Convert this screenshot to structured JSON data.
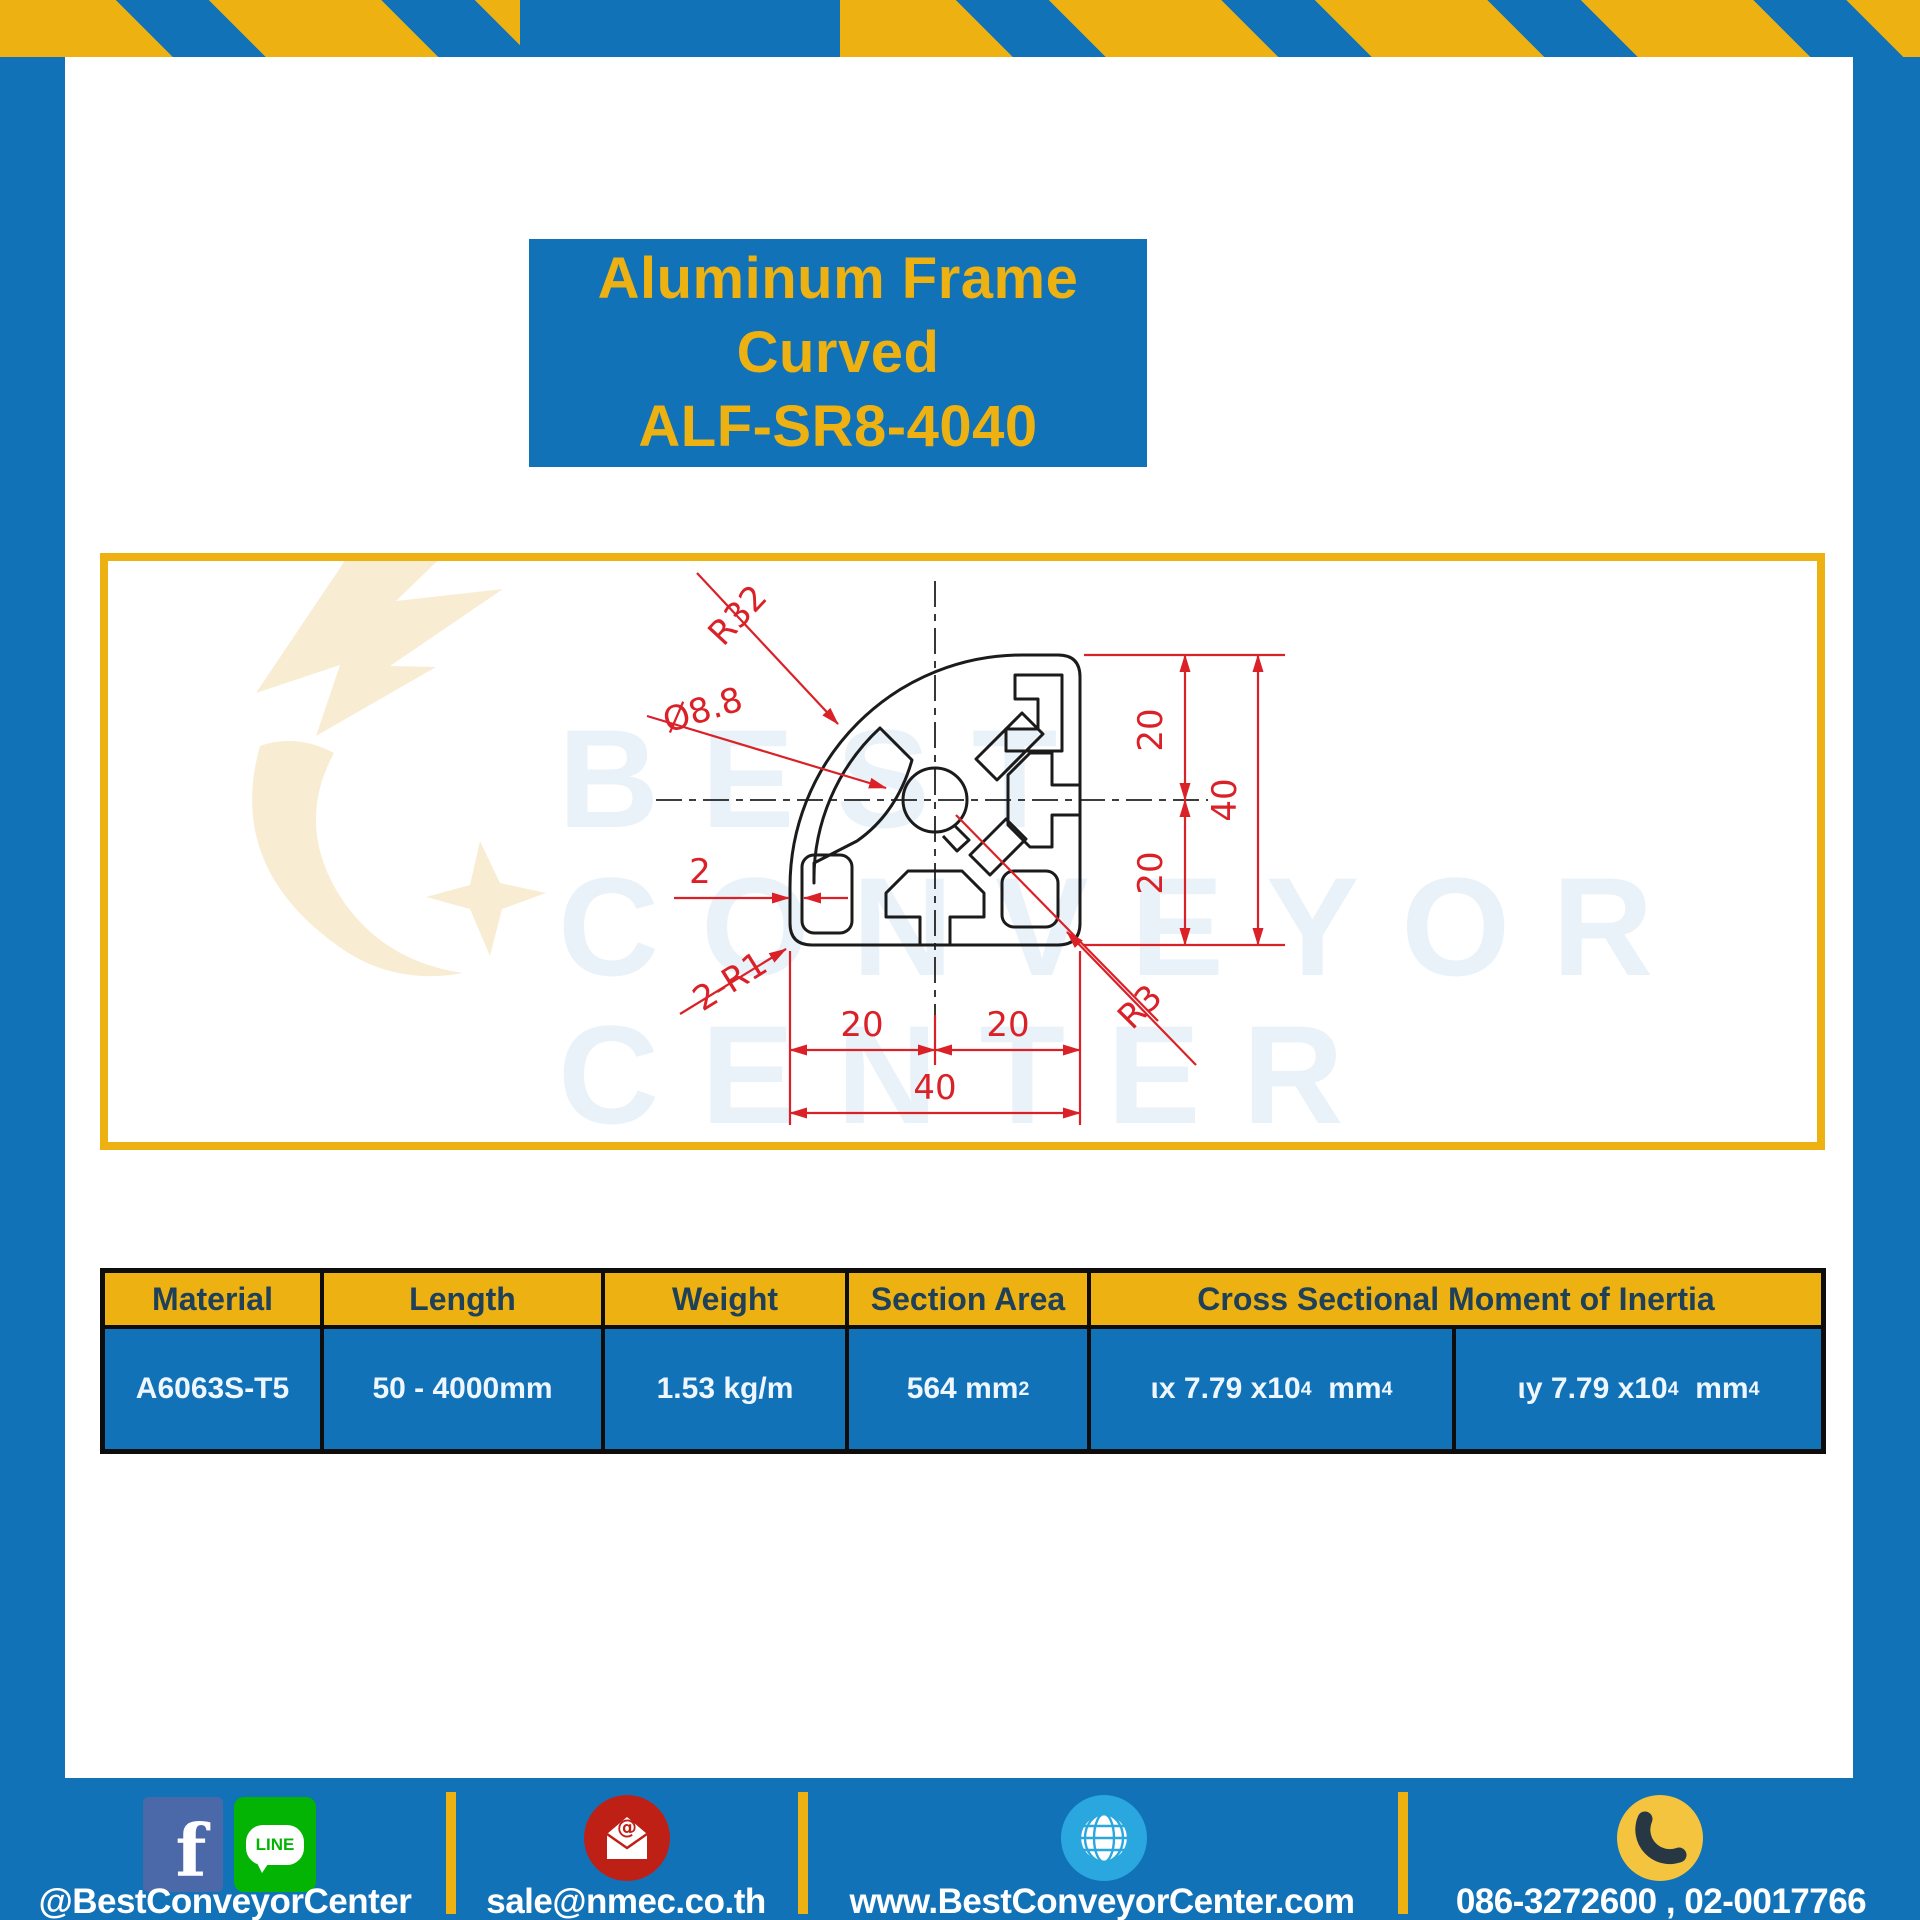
{
  "theme": {
    "frame_blue": "#1272b8",
    "accent_yellow": "#edb111",
    "cad_red": "#da2128",
    "header_navy": "#1f4059",
    "table_text": "#eef7ff",
    "watermark_blue": "#e9f2f9",
    "watermark_cream": "#f8edd3",
    "fb_blue": "#4b69a8",
    "line_green": "#04b404",
    "mail_red": "#bf2016",
    "globe_blue": "#2aa7de",
    "phone_yellow": "#f5c43e"
  },
  "title": {
    "line1": "Aluminum Frame",
    "line2": "Curved",
    "line3": "ALF-SR8-4040"
  },
  "watermark": {
    "line1": "BEST",
    "line2": "CONVEYOR",
    "line3": "CENTER"
  },
  "drawing": {
    "dims": {
      "radius_outer": "R32",
      "bore_diameter": "Ø8.8",
      "wall_thickness": "2",
      "corner_fillet": "2-R1",
      "bottom_left_20": "20",
      "bottom_right_20": "20",
      "bottom_total_40": "40",
      "right_top_20": "20",
      "right_bottom_20": "20",
      "right_total_40": "40",
      "corner_radius": "R3"
    }
  },
  "table": {
    "headers": [
      "Material",
      "Length",
      "Weight",
      "Section Area",
      "Cross Sectional Moment of Inertia"
    ],
    "row": {
      "material": "A6063S-T5",
      "length": "50 - 4000mm",
      "weight": "1.53 kg/m",
      "section_area": {
        "value": "564 mm",
        "sup": "2"
      },
      "inertia_x": {
        "value": "ιx 7.79 x10",
        "sup1": "4",
        "unit": "  mm",
        "sup2": "4"
      },
      "inertia_y": {
        "value": "ιy 7.79 x10",
        "sup1": "4",
        "unit": "  mm",
        "sup2": "4"
      }
    }
  },
  "footer": {
    "facebook_letter": "f",
    "line_word": "LINE",
    "social_handle": "@BestConveyorCenter",
    "email": "sale@nmec.co.th",
    "website": "www.BestConveyorCenter.com",
    "phone": "086-3272600 , 02-0017766"
  }
}
